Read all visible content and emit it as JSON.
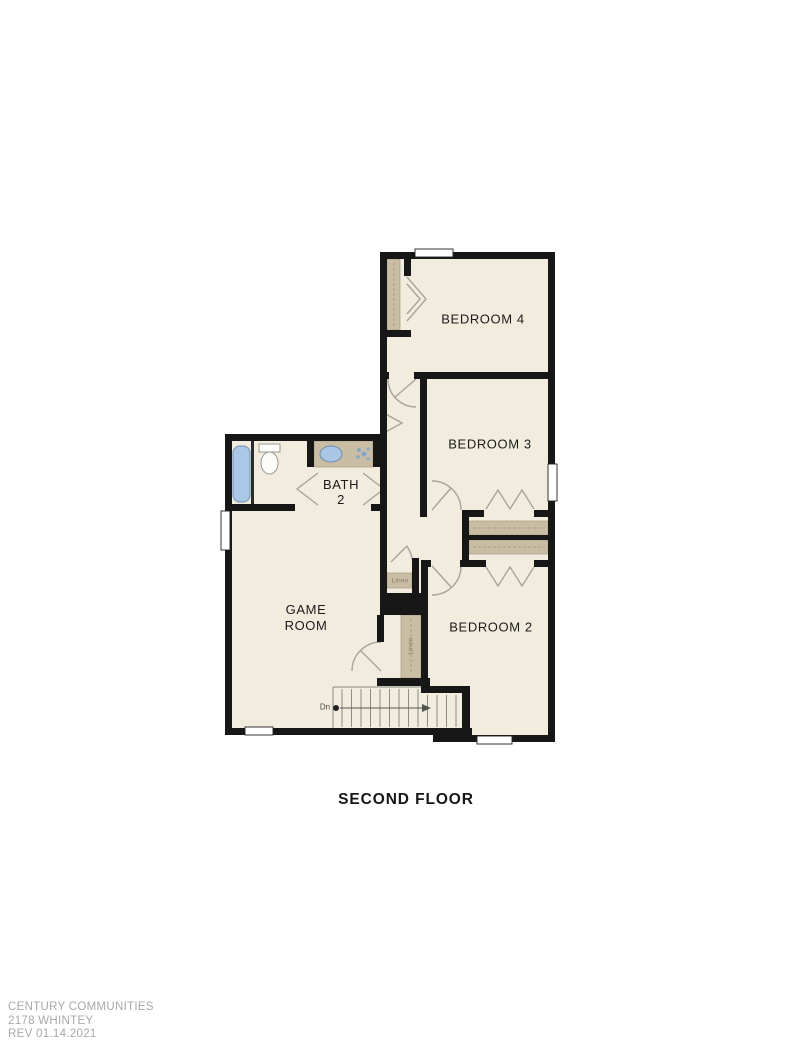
{
  "document": {
    "title": "SECOND FLOOR",
    "footer": {
      "line1": "CENTURY COMMUNITIES",
      "line2": "2178 WHINTEY",
      "line3": "REV 01.14.2021"
    }
  },
  "rooms": {
    "bedroom4": {
      "label": "BEDROOM 4"
    },
    "bedroom3": {
      "label": "BEDROOM 3"
    },
    "bedroom2": {
      "label": "BEDROOM 2"
    },
    "bath2": {
      "line1": "BATH",
      "line2": "2"
    },
    "game_room": {
      "line1": "GAME",
      "line2": "ROOM"
    }
  },
  "closets": {
    "linen_upper": {
      "label": "Linen"
    },
    "linen_lower": {
      "label": "Linen"
    }
  },
  "stairs": {
    "direction_label": "Dn"
  },
  "colors": {
    "background": "#ffffff",
    "floor": "#f2ecdf",
    "wall": "#171717",
    "shelf_tan": "#c9bda4",
    "shelf_dash": "#a3967a",
    "fixture_blue": "#aac7e5",
    "sink_blue": "#a9c6e4",
    "door_line": "#a5a599",
    "stair_line": "#8b8b83",
    "label_text": "#1b1b1b",
    "linen_text": "#837b69",
    "footer_text": "#a8a8a8"
  }
}
